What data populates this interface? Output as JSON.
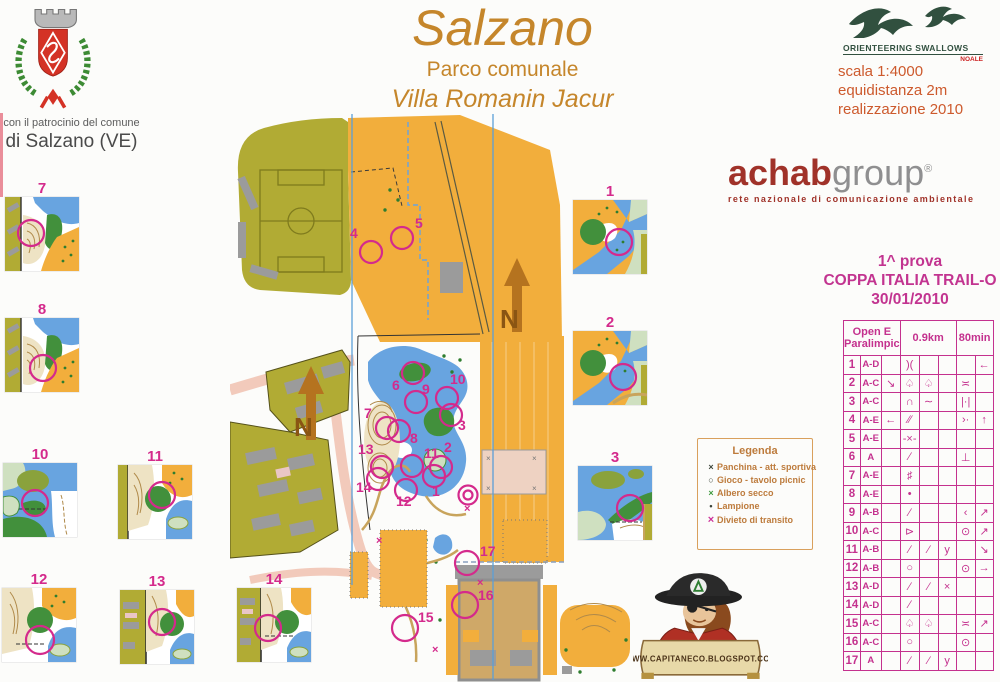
{
  "patronage": {
    "line1": "con il patrocinio del comune",
    "line2": "di Salzano (VE)"
  },
  "title": {
    "main": "Salzano",
    "sub1": "Parco comunale",
    "sub2": "Villa Romanin Jacur"
  },
  "swallows": {
    "name": "ORIENTEERING  SWALLOWS",
    "city": "NOALE"
  },
  "map_info": {
    "scale": "scala 1:4000",
    "equidistance": "equidistanza  2m",
    "realization": "realizzazione 2010"
  },
  "achab": {
    "brand_red": "achab",
    "brand_gray": "group",
    "reg": "®",
    "tagline": "rete nazionale di comunicazione ambientale"
  },
  "event": {
    "line1": "1^ prova",
    "line2": "COPPA ITALIA TRAIL-O",
    "line3": "30/01/2010"
  },
  "control_table": {
    "header": {
      "class": "Open E\nParalimpic",
      "length": "0.9km",
      "time": "80min"
    },
    "rows": [
      {
        "n": "1",
        "cls": "A-D",
        "c": "",
        "d": ")(",
        "e": "",
        "f": "",
        "g": "",
        "h": "←"
      },
      {
        "n": "2",
        "cls": "A-C",
        "c": "↘",
        "d": "♤",
        "e": "♤",
        "f": "",
        "g": "≍",
        "h": ""
      },
      {
        "n": "3",
        "cls": "A-C",
        "c": "",
        "d": "∩",
        "e": "∼",
        "f": "",
        "g": "|·|",
        "h": ""
      },
      {
        "n": "4",
        "cls": "A-E",
        "c": "←",
        "d": "∕∕",
        "e": "",
        "f": "",
        "g": "›·",
        "h": "↑"
      },
      {
        "n": "5",
        "cls": "A-E",
        "c": "",
        "d": "-×-",
        "e": "",
        "f": "",
        "g": "",
        "h": ""
      },
      {
        "n": "6",
        "cls": "A",
        "c": "",
        "d": "∕",
        "e": "",
        "f": "",
        "g": "⊥",
        "h": ""
      },
      {
        "n": "7",
        "cls": "A-E",
        "c": "",
        "d": "♯",
        "e": "",
        "f": "",
        "g": "",
        "h": ""
      },
      {
        "n": "8",
        "cls": "A-E",
        "c": "",
        "d": "•",
        "e": "",
        "f": "",
        "g": "",
        "h": ""
      },
      {
        "n": "9",
        "cls": "A-B",
        "c": "",
        "d": "∕",
        "e": "",
        "f": "",
        "g": "‹",
        "h": "↗"
      },
      {
        "n": "10",
        "cls": "A-C",
        "c": "",
        "d": "⊳",
        "e": "",
        "f": "",
        "g": "⊙",
        "h": "↗"
      },
      {
        "n": "11",
        "cls": "A-B",
        "c": "",
        "d": "∕",
        "e": "∕",
        "f": "y",
        "g": "",
        "h": "↘"
      },
      {
        "n": "12",
        "cls": "A-B",
        "c": "",
        "d": "○",
        "e": "",
        "f": "",
        "g": "⊙",
        "h": "→"
      },
      {
        "n": "13",
        "cls": "A-D",
        "c": "",
        "d": "∕",
        "e": "∕",
        "f": "×",
        "g": "",
        "h": ""
      },
      {
        "n": "14",
        "cls": "A-D",
        "c": "",
        "d": "∕",
        "e": "",
        "f": "",
        "g": "",
        "h": ""
      },
      {
        "n": "15",
        "cls": "A-C",
        "c": "",
        "d": "♤",
        "e": "♤",
        "f": "",
        "g": "≍",
        "h": "↗"
      },
      {
        "n": "16",
        "cls": "A-C",
        "c": "",
        "d": "○",
        "e": "",
        "f": "",
        "g": "⊙",
        "h": ""
      },
      {
        "n": "17",
        "cls": "A",
        "c": "",
        "d": "∕",
        "e": "∕",
        "f": "y",
        "g": "",
        "h": ""
      }
    ]
  },
  "legend": {
    "title": "Legenda",
    "items": [
      {
        "sym": "×",
        "label": "Panchina - att. sportiva"
      },
      {
        "sym": "○",
        "label": "Gioco - tavolo picnic"
      },
      {
        "sym": "×",
        "label": "Albero secco"
      },
      {
        "sym": "•",
        "label": "Lampione"
      },
      {
        "sym": "×",
        "label": "Divieto di transito"
      }
    ]
  },
  "mascot": {
    "url": "WWW.CAPITANECO.BLOGSPOT.COM"
  },
  "tiles": [
    {
      "num": "7"
    },
    {
      "num": "8"
    },
    {
      "num": "10"
    },
    {
      "num": "11"
    },
    {
      "num": "12"
    },
    {
      "num": "13"
    },
    {
      "num": "14"
    },
    {
      "num": "1"
    },
    {
      "num": "2"
    },
    {
      "num": "3"
    }
  ],
  "map": {
    "north_label": "N"
  },
  "map_controls": [
    "1",
    "2",
    "3",
    "4",
    "5",
    "6",
    "7",
    "8",
    "9",
    "10",
    "11",
    "12",
    "13",
    "14",
    "15",
    "16",
    "17"
  ],
  "colors": {
    "magenta": "#d42a8c",
    "title_tan": "#c5862b",
    "scale_orange": "#cd5a2d",
    "legend_orange": "#bd7b3c",
    "achab_red": "#a03229",
    "olive": "#b1ab34",
    "open_orange": "#f2ae3c",
    "water_blue": "#68a4e0",
    "north_brown": "#b5731f"
  }
}
